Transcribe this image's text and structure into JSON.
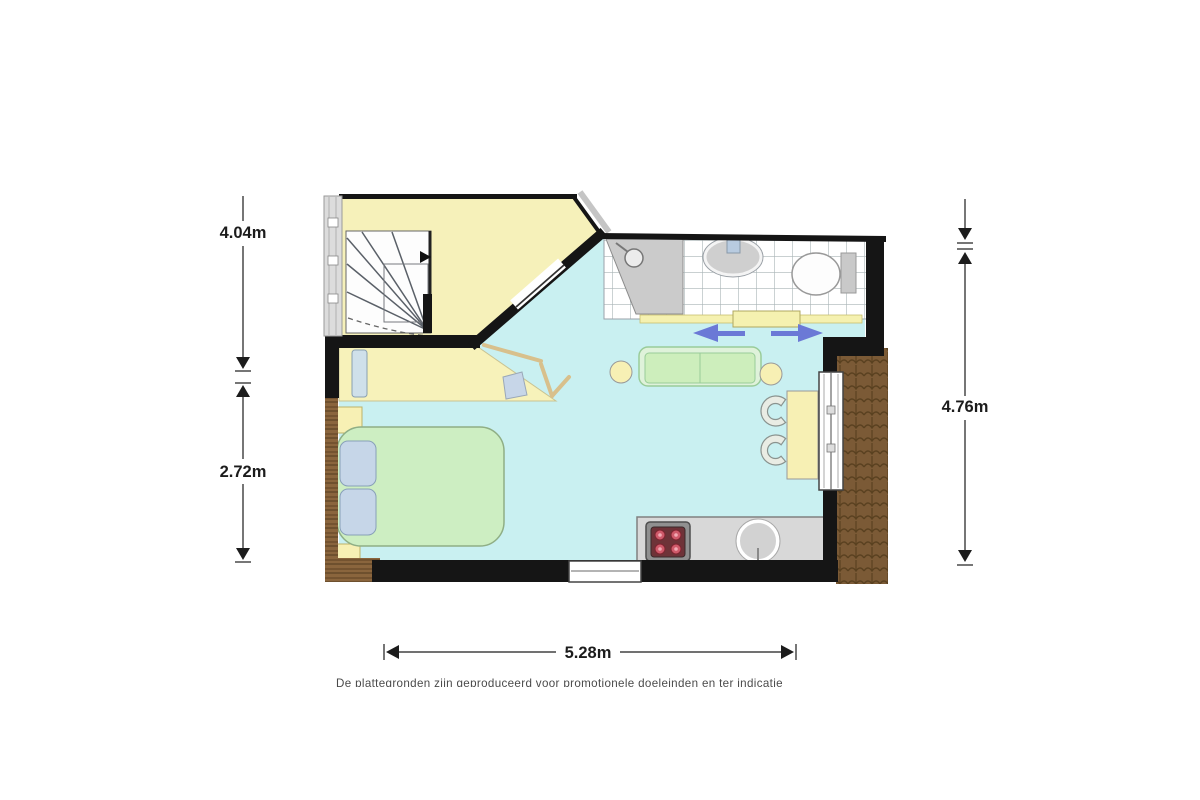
{
  "dimensions": {
    "left_top": "4.04m",
    "left_bottom": "2.72m",
    "right": "4.76m",
    "bottom": "5.28m"
  },
  "disclaimer": "De plattegronden zijn geproduceerd voor promotionele doeleinden en ter indicatie",
  "colors": {
    "wall": "#151515",
    "floor_main": "#c9f0f1",
    "floor_landing": "#f6f1ba",
    "bedroom_strip": "#f7f2ba",
    "bed_green": "#cdeec2",
    "sofa_green": "#cdeebc",
    "pillow_blue": "#c6d6e8",
    "furniture_yellow": "#f7f0b4",
    "counter_gray": "#d8d8d8",
    "shower_gray": "#cbcbcb",
    "roof_tile_brown": "#7b5a36",
    "wood_brown": "#8a653d",
    "slide_arrow_blue": "#6b79d6",
    "dimension_text": "#1c1c1c"
  },
  "fixtures": [
    "staircase",
    "landing",
    "wardrobe",
    "double-bed",
    "pillows",
    "nightstands",
    "sofa",
    "side-tables",
    "dining-table",
    "chairs",
    "kitchen-counter",
    "stove",
    "kitchen-sink",
    "shower",
    "washbasin",
    "toilet",
    "sliding-door",
    "window-right",
    "window-bottom",
    "roof-tiles",
    "wood-wall"
  ]
}
